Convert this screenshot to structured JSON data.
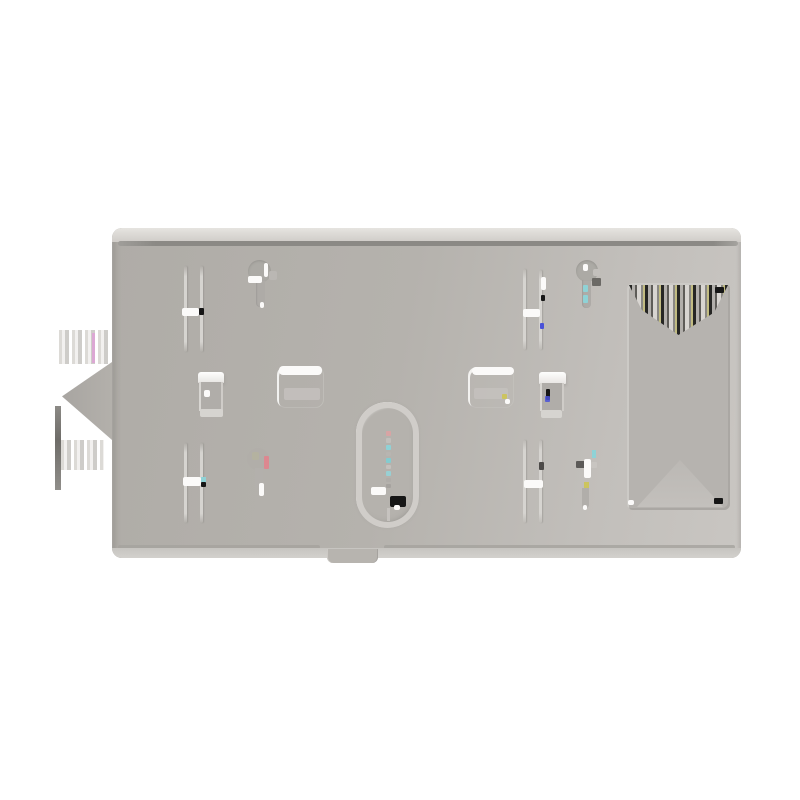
{
  "scene": {
    "type": "product-photo",
    "object_label": "gray rectangular wall-mount back plate on white background"
  },
  "colors": {
    "background": "#ffffff",
    "plate": "#b5b2ad",
    "plate_light": "#c9c6c2",
    "top_lip": "#dfddd9",
    "groove": "#8b8985",
    "bottom_strip": "#ceccc8",
    "cutout_fill": "#b6b3af",
    "stripe_dark": "#262624",
    "highlight": "#fbfaf9",
    "shadow": "#a3a09c",
    "mark_black": "#161616",
    "artifact_cyan": "#8fd2d6",
    "artifact_pink": "#d8a4a4",
    "artifact_red": "#dc8890",
    "artifact_blue": "#4a52d8",
    "artifact_yellow": "#ccc45e",
    "artifact_olive": "#b4b2a0",
    "artifact_magenta": "#dca8d4"
  },
  "parts": {
    "plate": "mounting back plate",
    "top_bevel": "beveled top lip",
    "top_groove": "horizontal groove line",
    "screw_slot": "vertical screw slot",
    "keyhole": "keyhole screw mount",
    "wire_cutout": "large rectangular wiring cutout",
    "center_oval": "oval leveling opening",
    "clip_recess": "clip recess",
    "bottom_tab": "bottom release tab",
    "side_tab": "left side alignment tab"
  }
}
